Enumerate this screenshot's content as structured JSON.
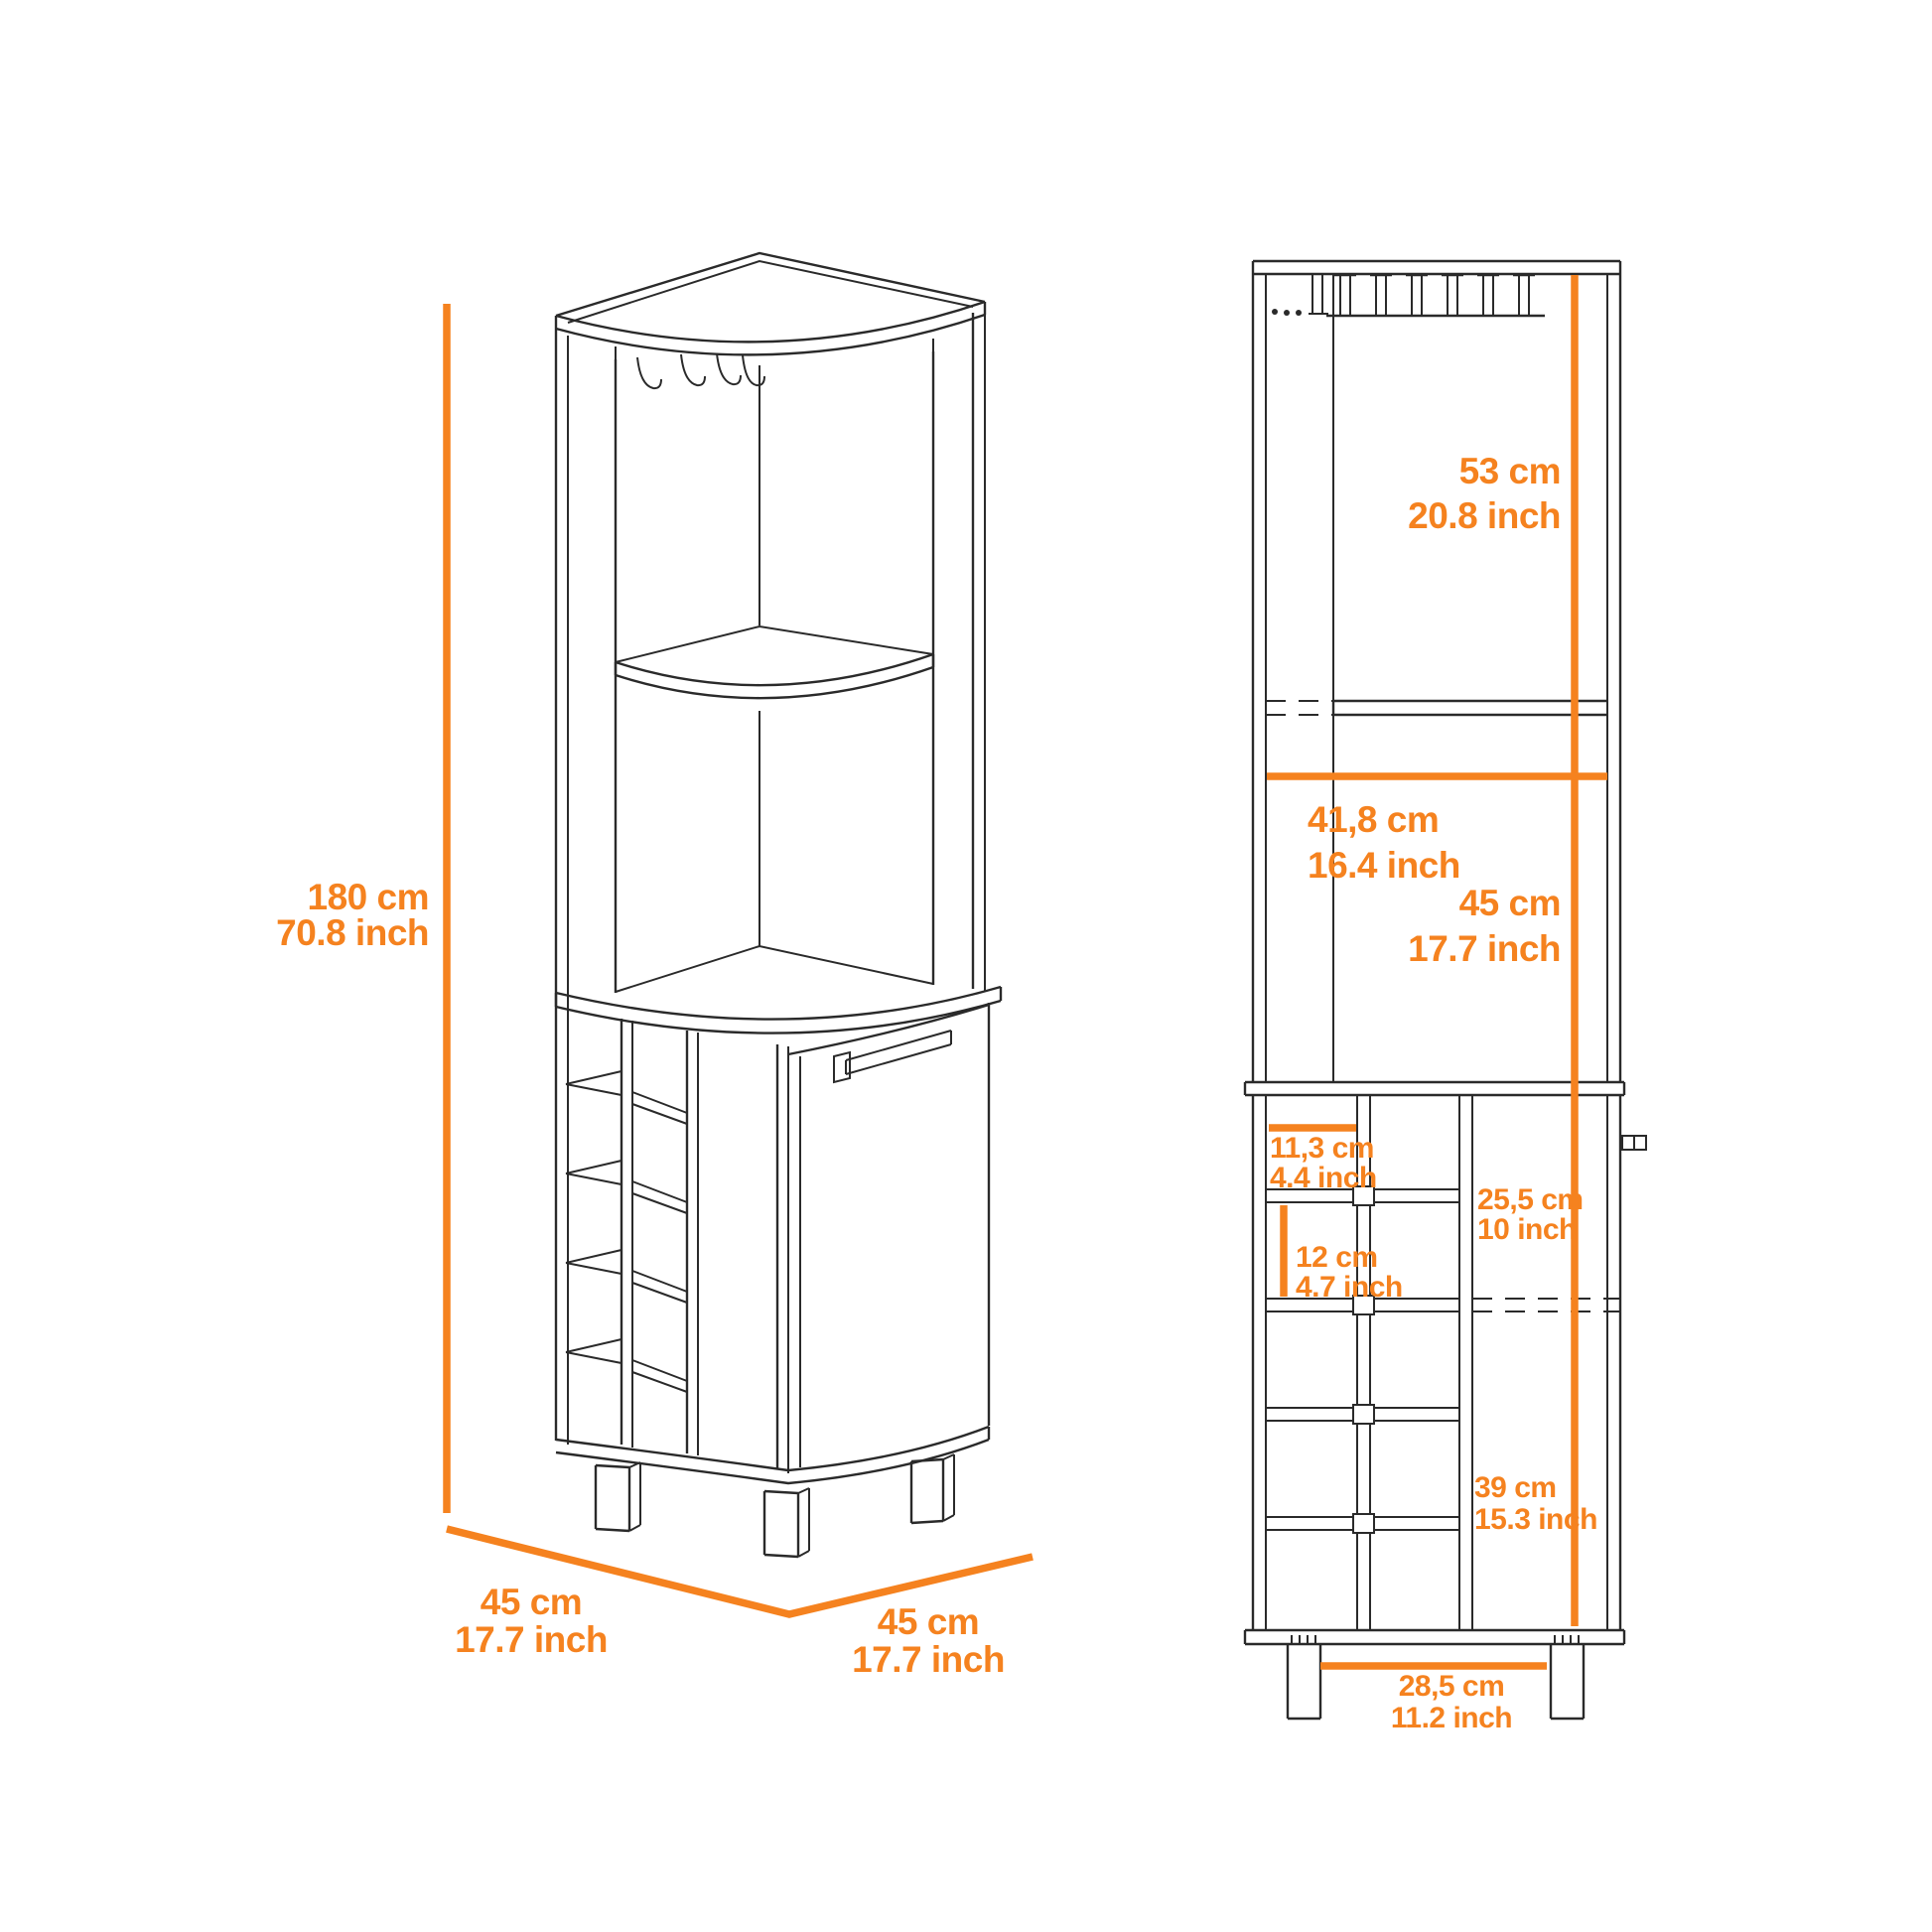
{
  "colors": {
    "accent": "#F5821F",
    "ink": "#2A2A2A",
    "background": "#FFFFFF"
  },
  "diagram": {
    "product": "corner bar cabinet dimension diagram",
    "perspective_view": {
      "height": {
        "cm": "180 cm",
        "inch": "70.8 inch"
      },
      "depth_left": {
        "cm": "45 cm",
        "inch": "17.7 inch"
      },
      "width_right": {
        "cm": "45 cm",
        "inch": "17.7 inch"
      }
    },
    "front_view": {
      "top_section_height": {
        "cm": "53 cm",
        "inch": "20.8 inch"
      },
      "interior_width": {
        "cm": "41,8 cm",
        "inch": "16.4 inch"
      },
      "middle_section_height": {
        "cm": "45 cm",
        "inch": "17.7 inch"
      },
      "bottle_slot_width": {
        "cm": "11,3 cm",
        "inch": "4.4 inch"
      },
      "door_width": {
        "cm": "25,5 cm",
        "inch": "10 inch"
      },
      "bottle_slot_height": {
        "cm": "12 cm",
        "inch": "4.7 inch"
      },
      "lower_section_height": {
        "cm": "39 cm",
        "inch": "15.3 inch"
      },
      "leg_spacing": {
        "cm": "28,5 cm",
        "inch": "11.2 inch"
      }
    }
  }
}
